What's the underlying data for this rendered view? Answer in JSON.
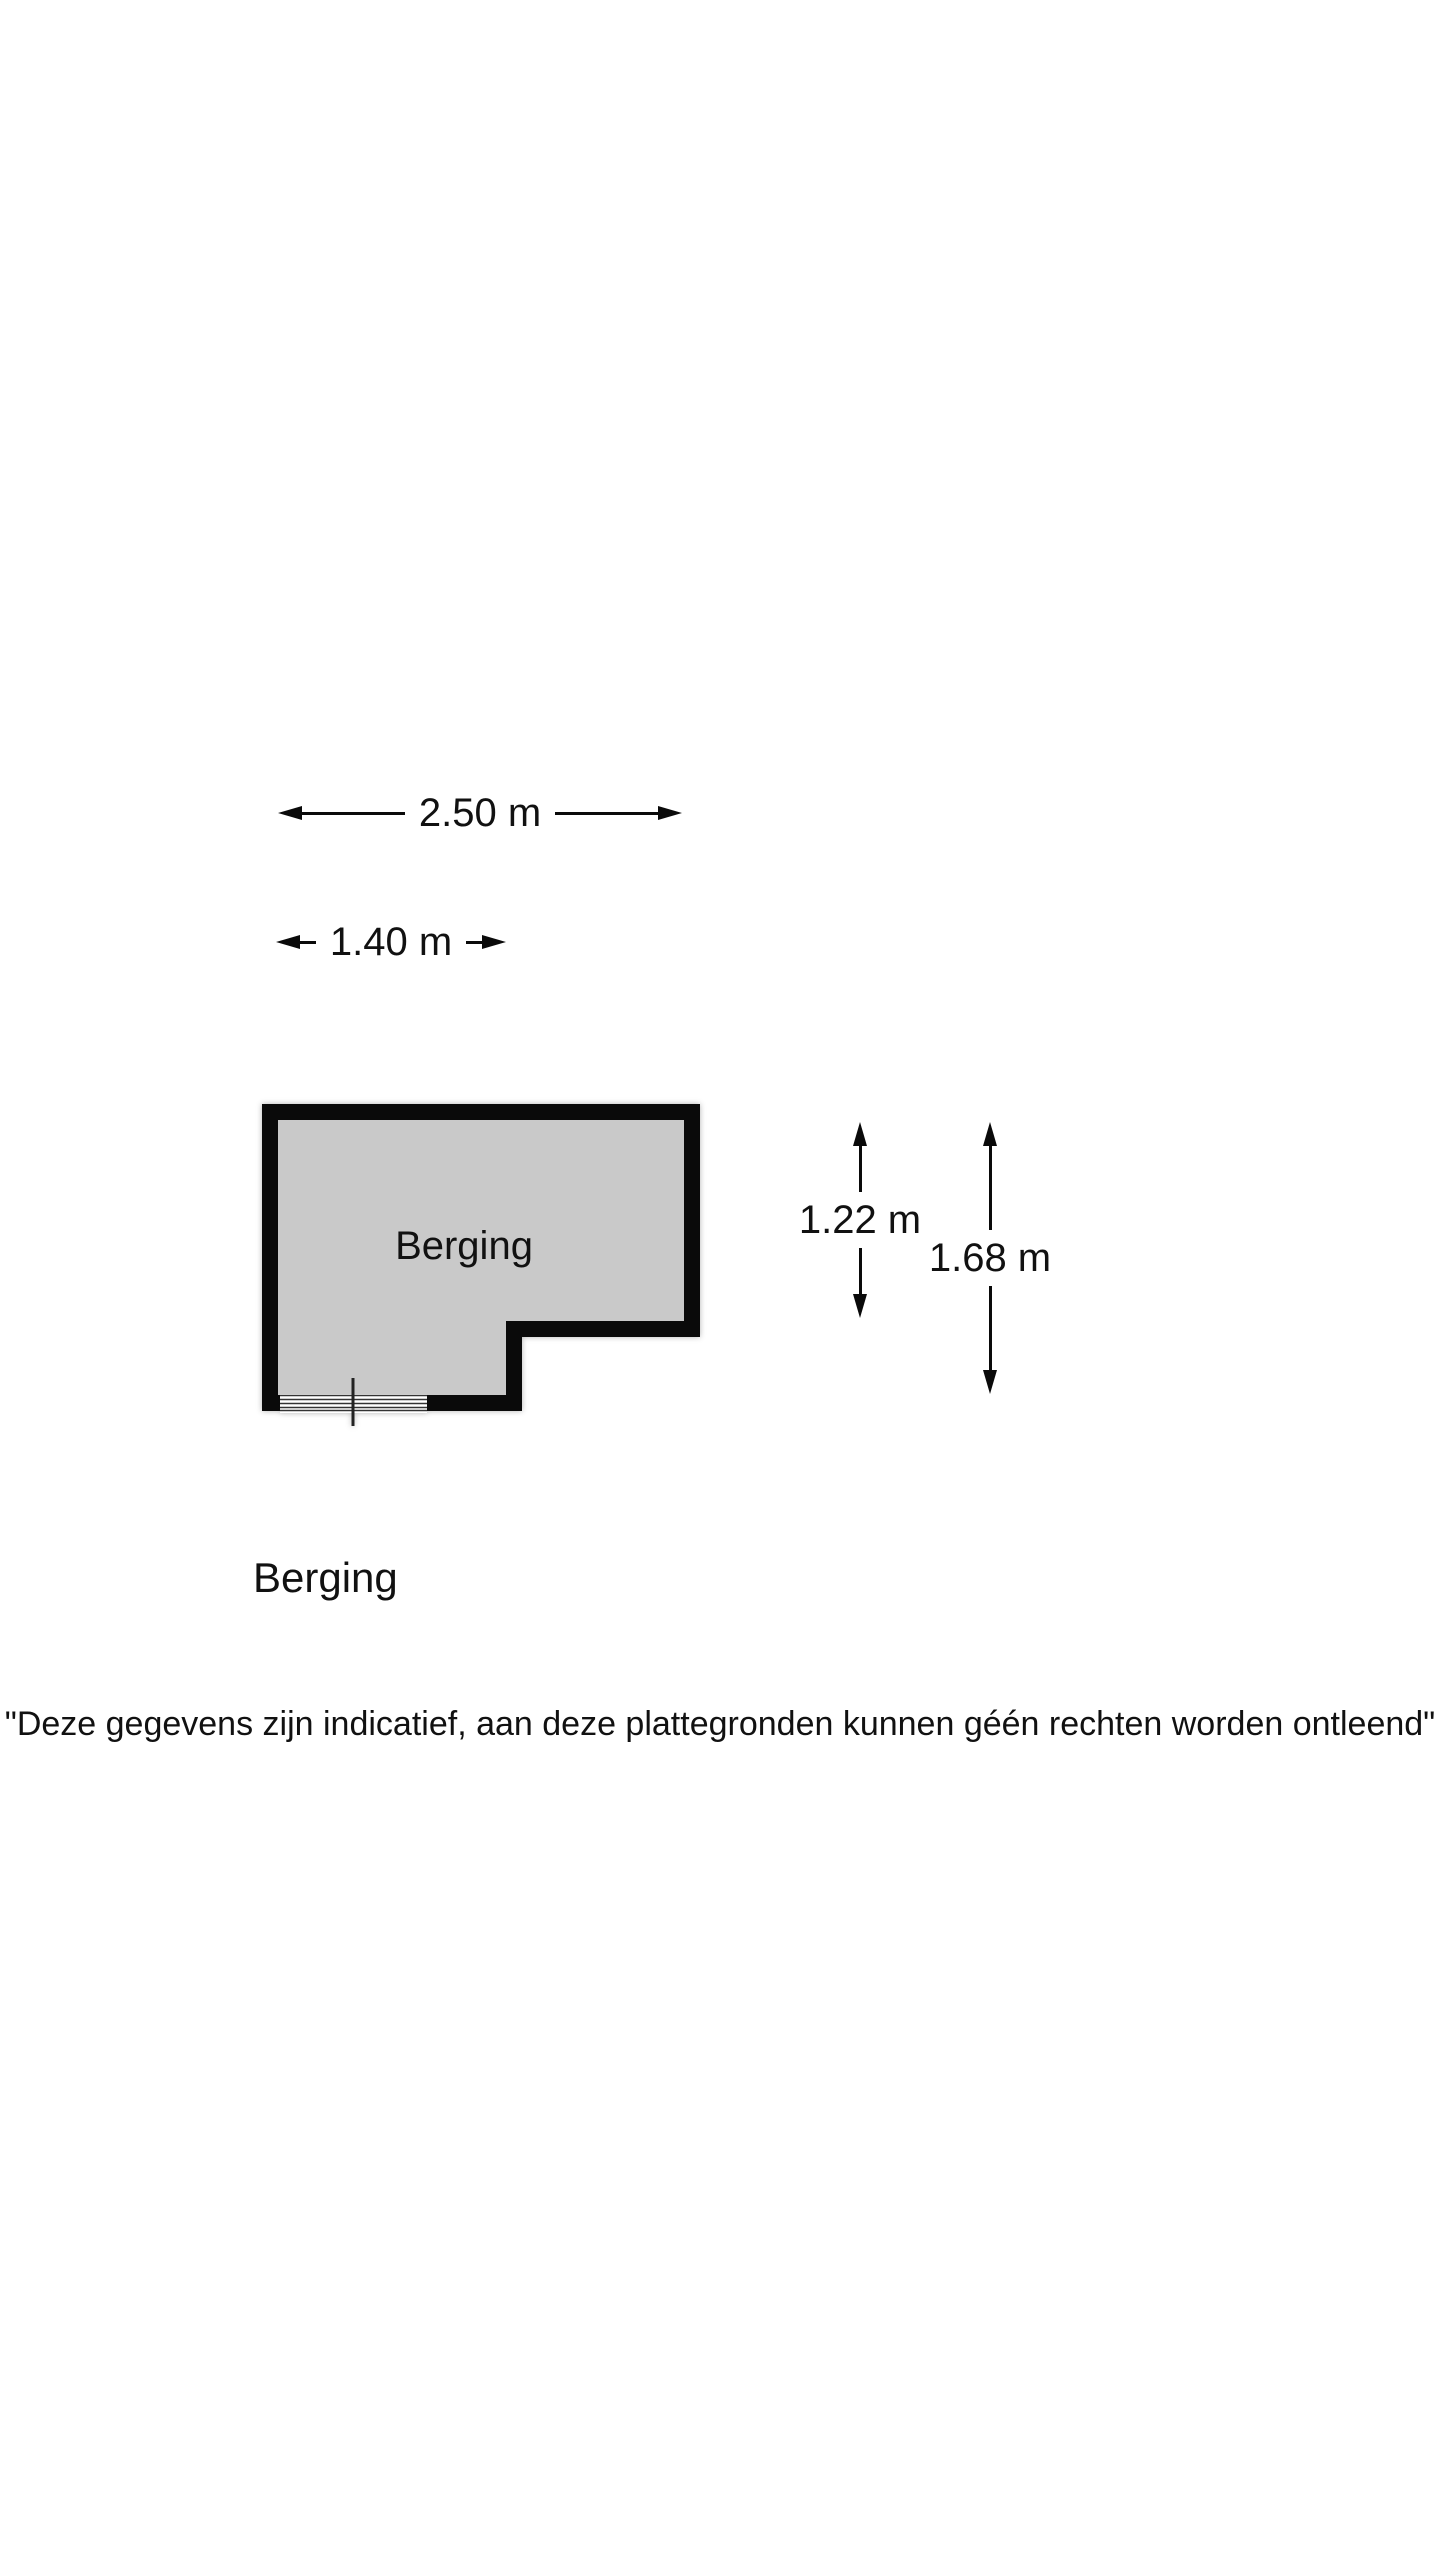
{
  "page": {
    "background_color": "#ffffff",
    "text_color": "#111111"
  },
  "floor_plan": {
    "room_label": "Berging",
    "room_fill_color": "#c9c9c9",
    "wall_color": "#0a0a0a",
    "dimensions": {
      "total_width": "2.50 m",
      "partial_width": "1.40 m",
      "partial_height": "1.22 m",
      "total_height": "1.68 m"
    },
    "features": {
      "window_symbol": "window-lines-bottom-left",
      "door_marker": "vertical-tick-through-window"
    }
  },
  "section_title": "Berging",
  "disclaimer": "\"Deze gegevens zijn indicatief, aan deze plattegronden kunnen géén rechten worden ontleend\""
}
